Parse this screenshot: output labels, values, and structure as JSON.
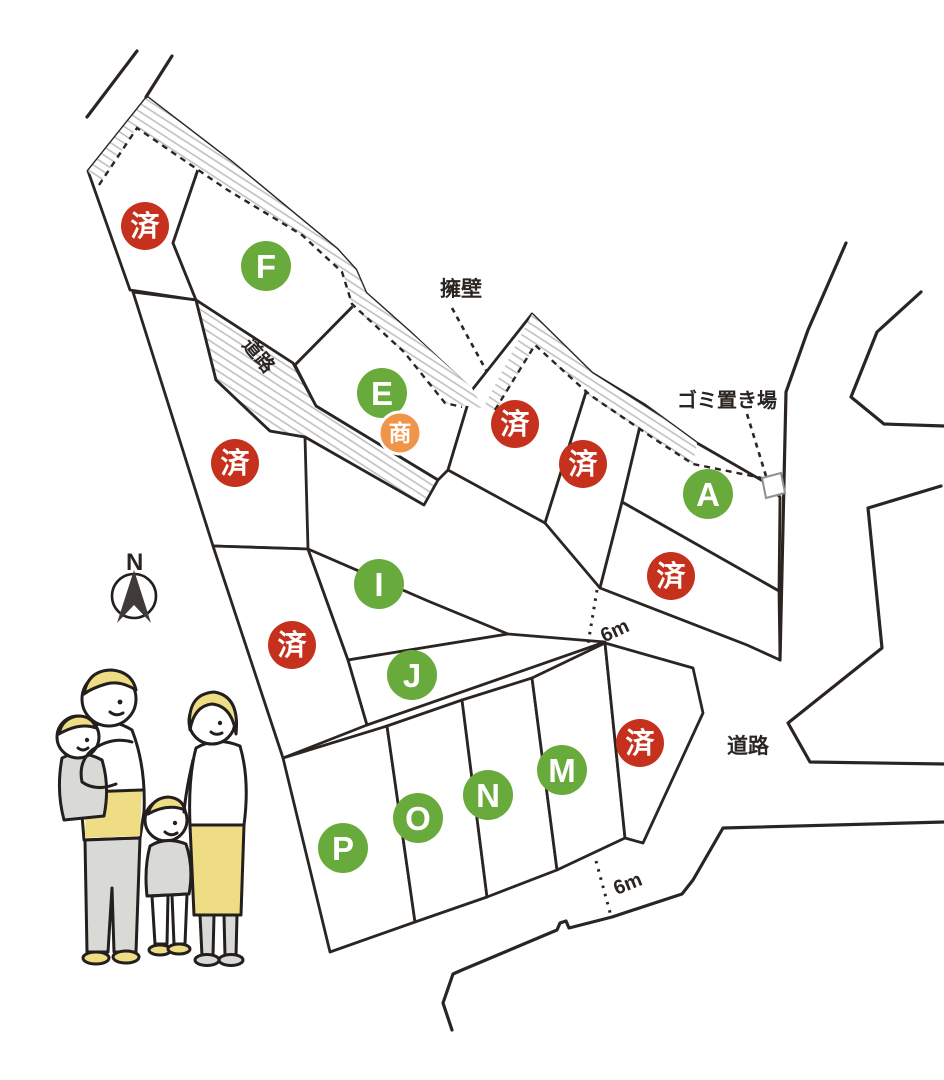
{
  "map": {
    "compass_north": "N",
    "labels": {
      "retaining_wall": "擁壁",
      "garbage_station": "ゴミ置き場",
      "road_upper": "道路",
      "road_right": "道路",
      "road_width_upper": "6m",
      "road_width_lower": "6m"
    },
    "lots": {
      "available": [
        {
          "label": "F"
        },
        {
          "label": "E"
        },
        {
          "label": "A"
        },
        {
          "label": "I"
        },
        {
          "label": "J"
        },
        {
          "label": "M"
        },
        {
          "label": "N"
        },
        {
          "label": "O"
        },
        {
          "label": "P"
        }
      ],
      "sold_label": "済",
      "sold_count": 7,
      "commercial_label": "商"
    },
    "colors": {
      "available": "#69aa3c",
      "sold": "#c5311c",
      "commercial": "#ef9449",
      "outline": "#2b2522",
      "hatch": "#bcbcbc",
      "family_yellow": "#eedd84",
      "family_gray": "#d9d9d6"
    }
  }
}
